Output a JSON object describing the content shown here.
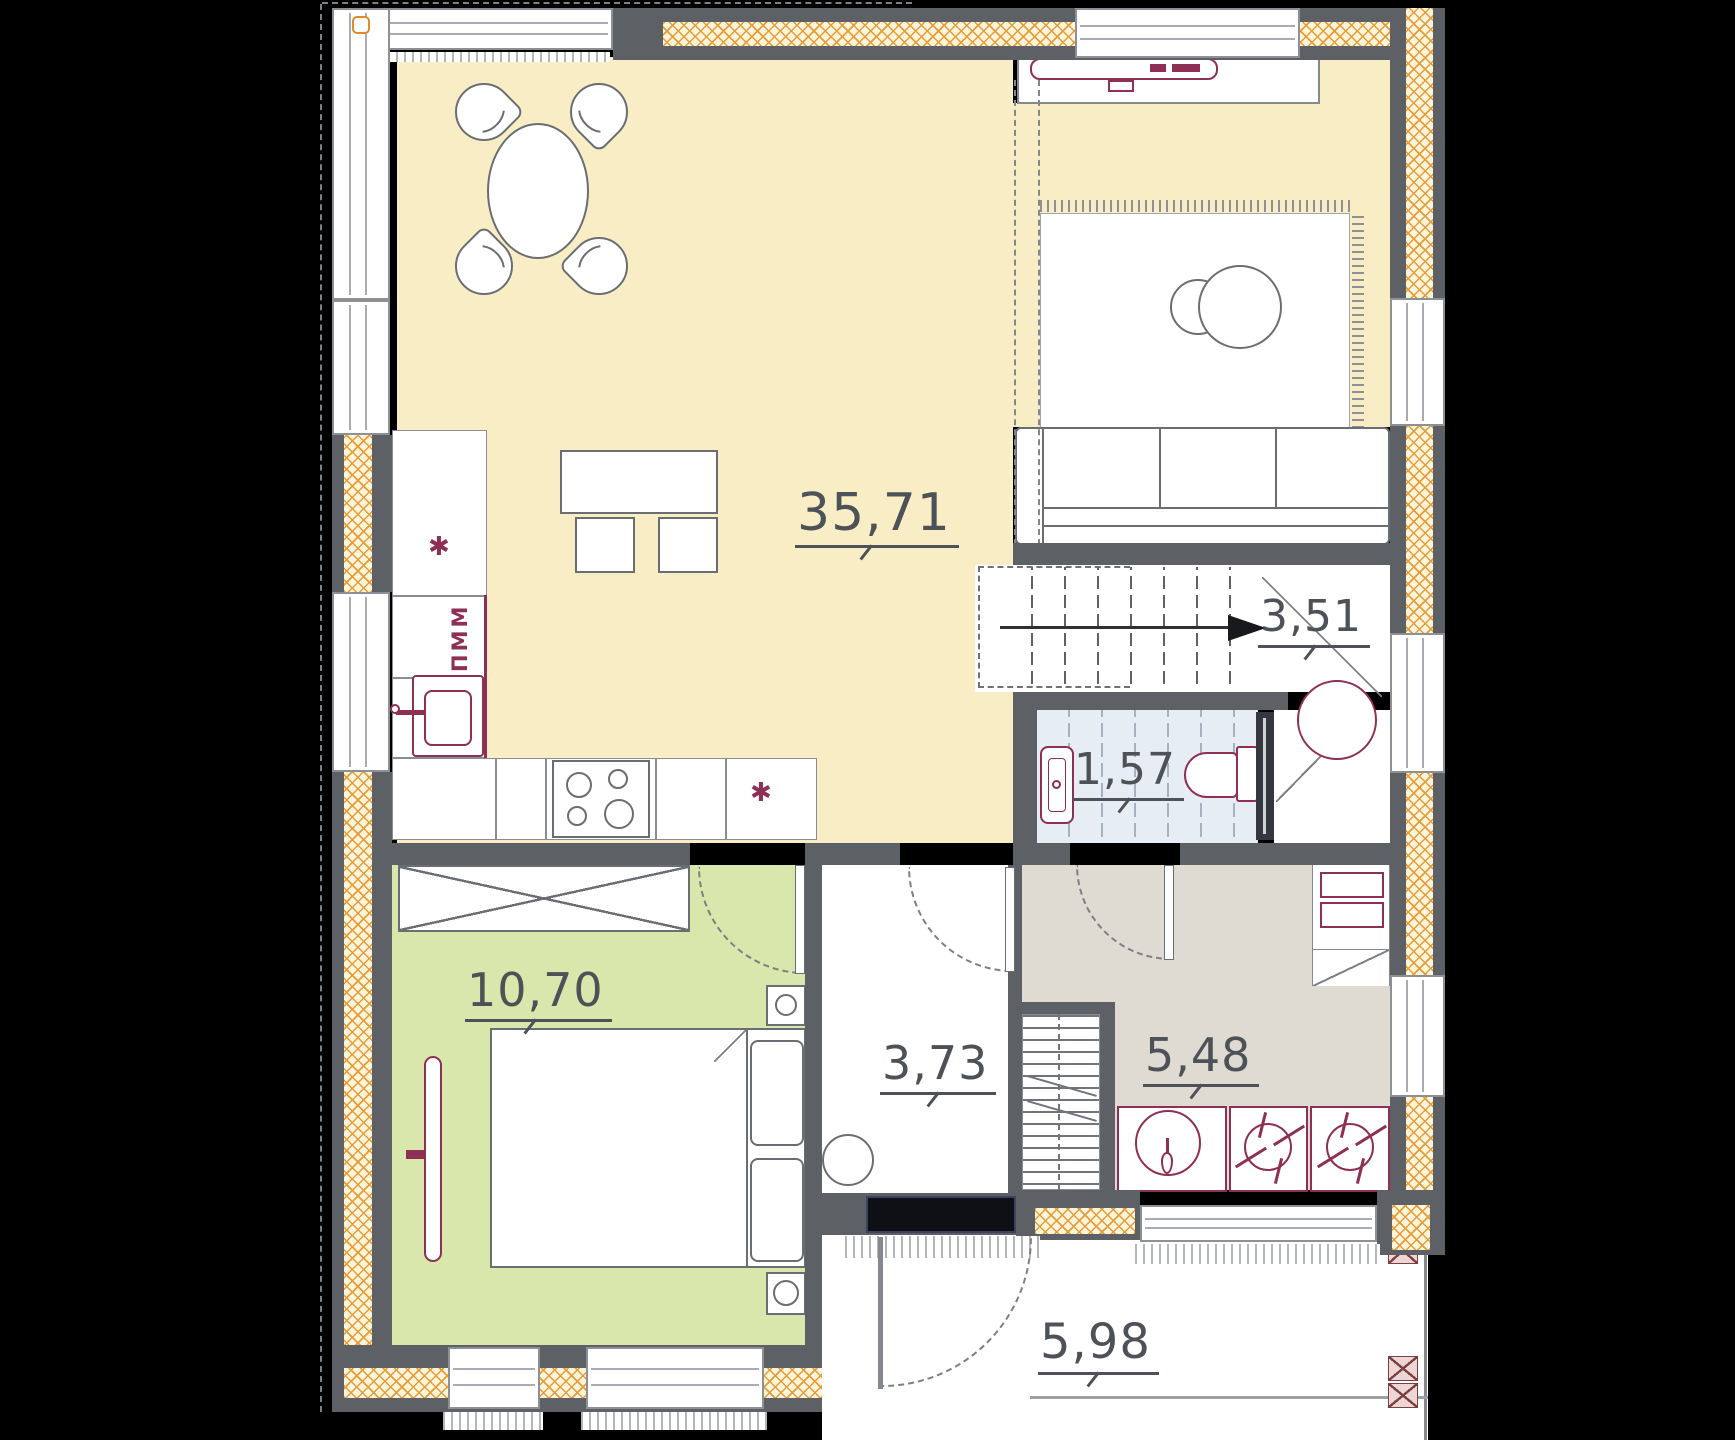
{
  "plan": {
    "type": "floor-plan",
    "rooms": {
      "living_kitchen": {
        "area": "35,71"
      },
      "stair_hall": {
        "area": "3,51"
      },
      "bathroom": {
        "area": "1,57"
      },
      "hallway": {
        "area": "3,73"
      },
      "utility": {
        "area": "5,48"
      },
      "bedroom": {
        "area": "10,70"
      },
      "porch": {
        "area": "5,98"
      }
    },
    "labels": {
      "dishwasher": "ПММ",
      "hob_mark": "✱"
    },
    "colors": {
      "bg": "#000000",
      "living-fill": "#f8edc5",
      "bedroom-fill": "#d9e7ad",
      "bath-fill": "#e7edf4",
      "utility-fill": "#e0dbd2",
      "wall": "#5d6065",
      "magenta": "#8e2f55",
      "label": "#4c5257",
      "insulation-line": "#e89c36",
      "insulation-bg": "#fdf4dc"
    }
  }
}
